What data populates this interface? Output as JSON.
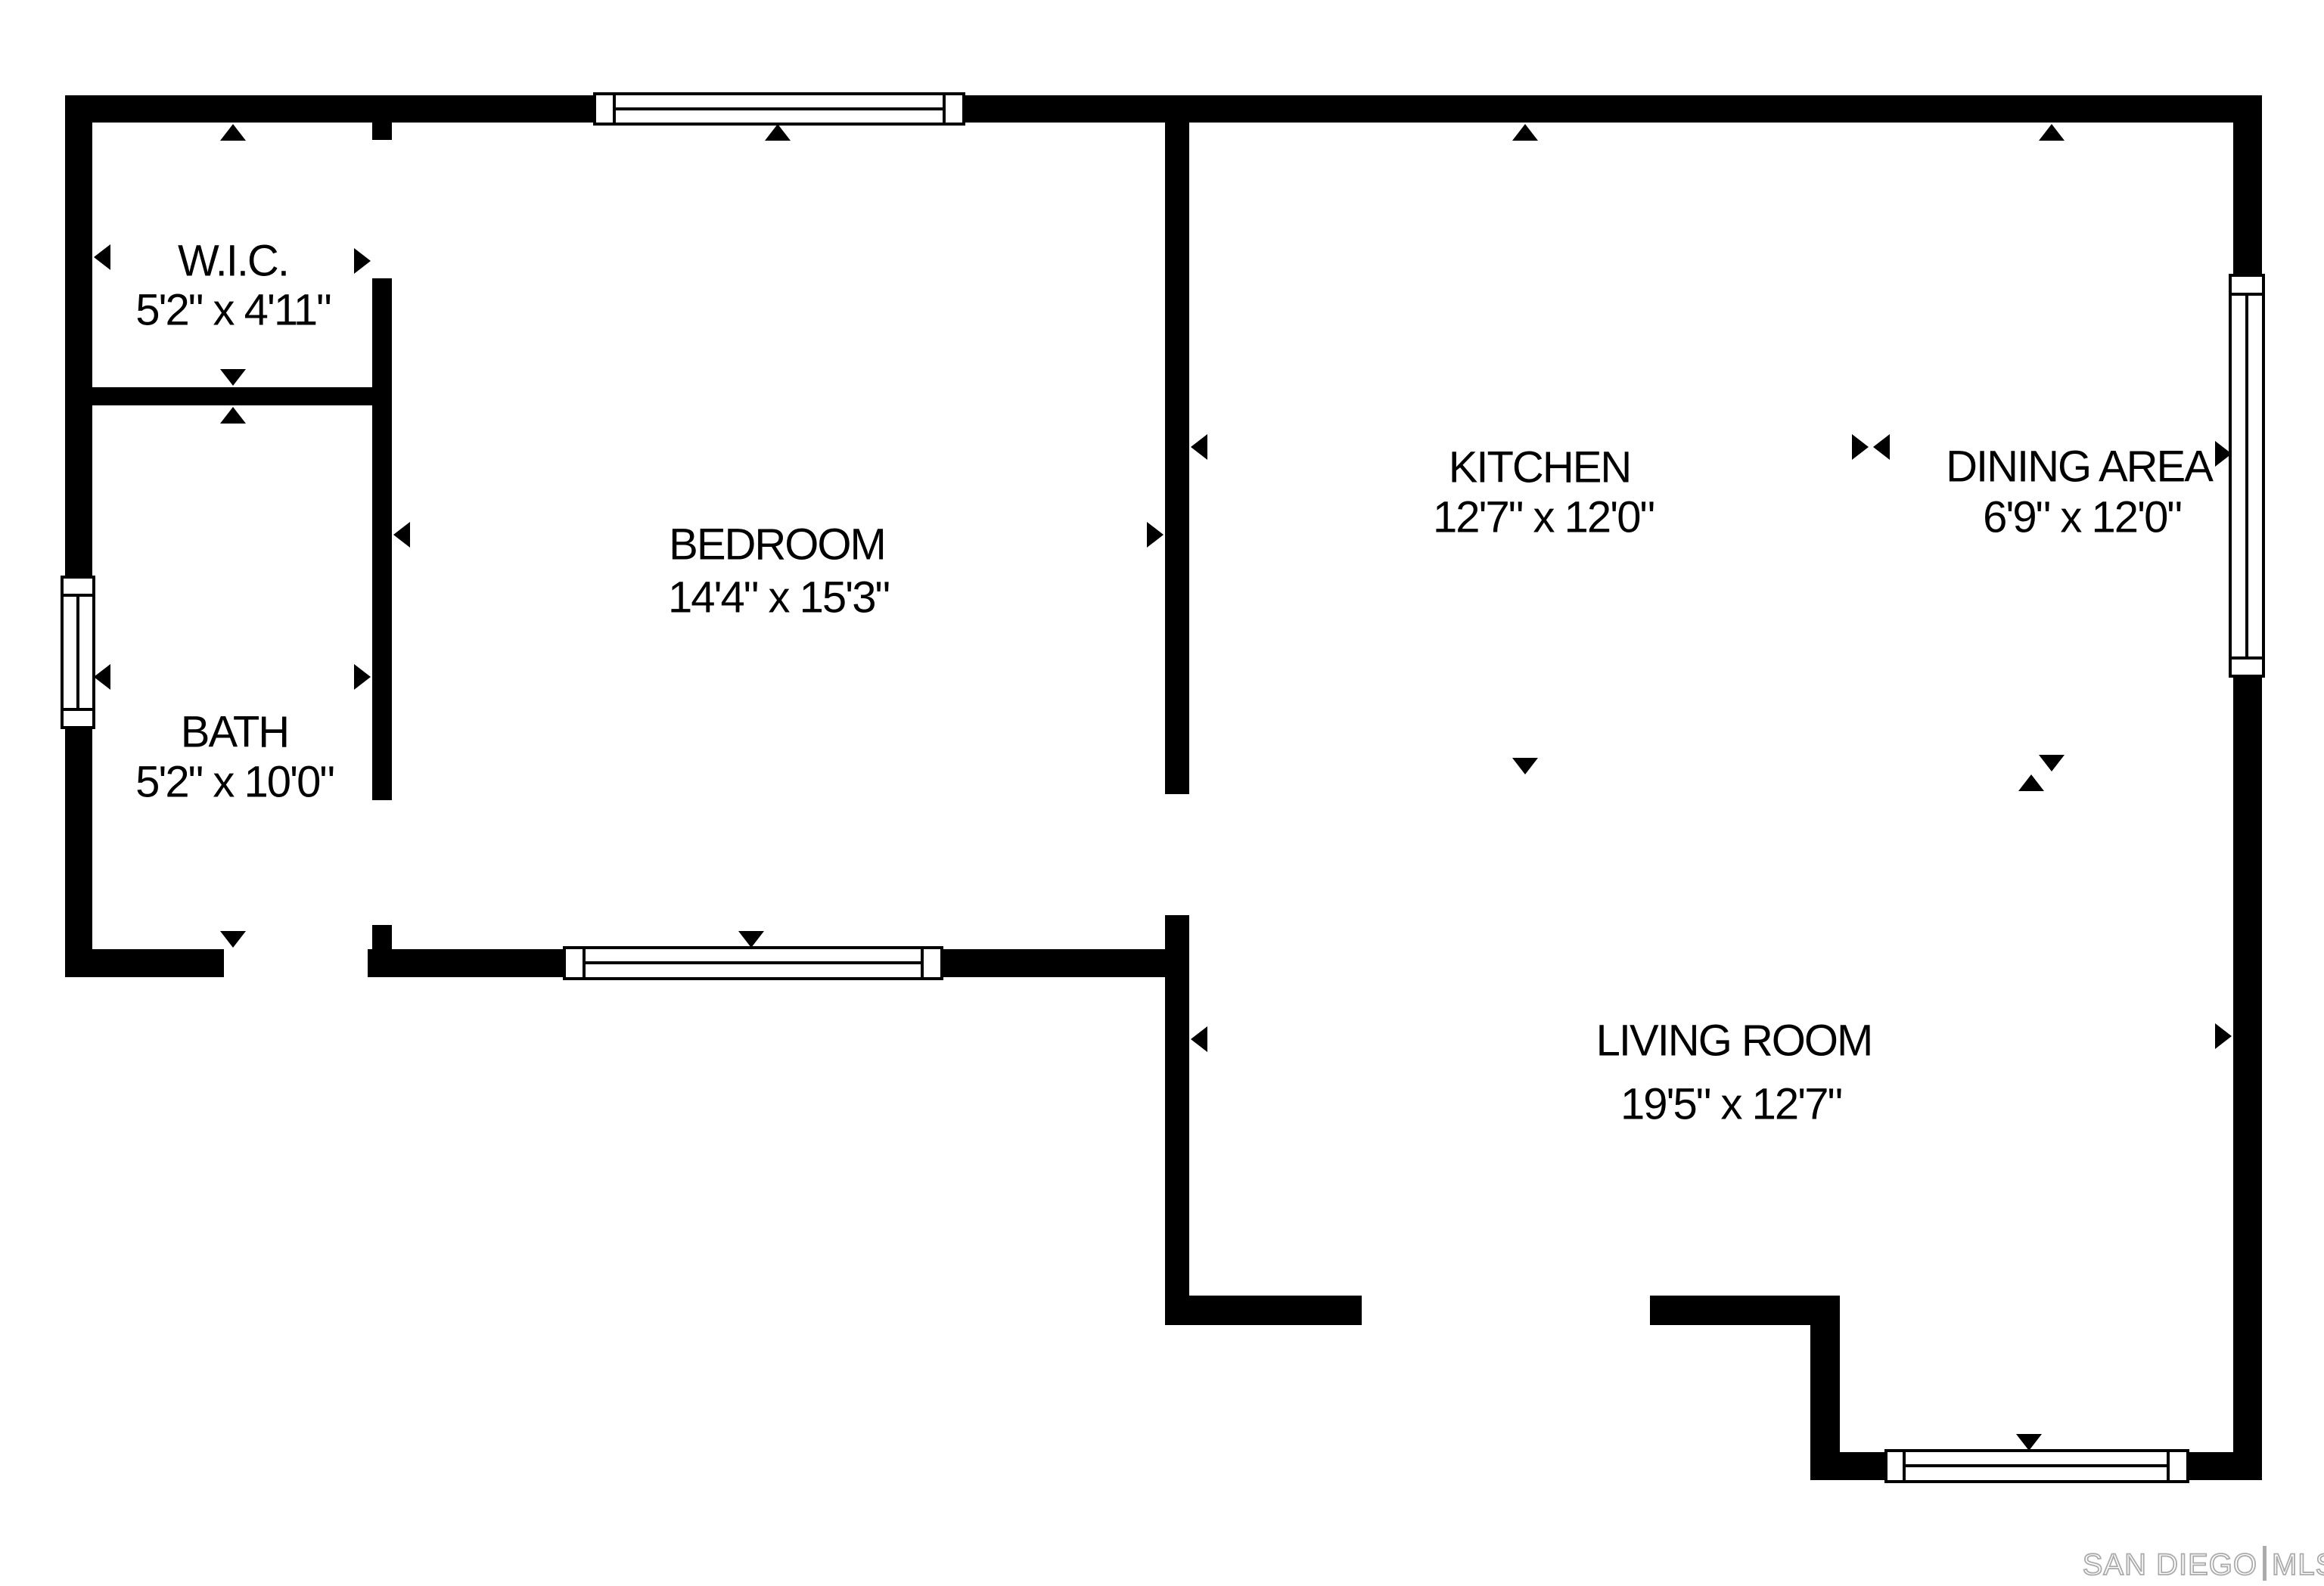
{
  "floorplan": {
    "rooms": {
      "wic": {
        "name": "W.I.C.",
        "dims": "5'2\" x 4'11\""
      },
      "bath": {
        "name": "BATH",
        "dims": "5'2\" x 10'0\""
      },
      "bedroom": {
        "name": "BEDROOM",
        "dims": "14'4\" x 15'3\""
      },
      "kitchen": {
        "name": "KITCHEN",
        "dims": "12'7\" x 12'0\""
      },
      "dining": {
        "name": "DINING AREA",
        "dims": "6'9\" x 12'0\""
      },
      "living": {
        "name": "LIVING ROOM",
        "dims": "19'5\" x 12'7\""
      }
    },
    "watermark": {
      "brand": "SAN DIEGO",
      "suffix": "MLS"
    }
  },
  "colors": {
    "wall": "#000000",
    "background": "#ffffff",
    "watermark": "#ababab"
  }
}
